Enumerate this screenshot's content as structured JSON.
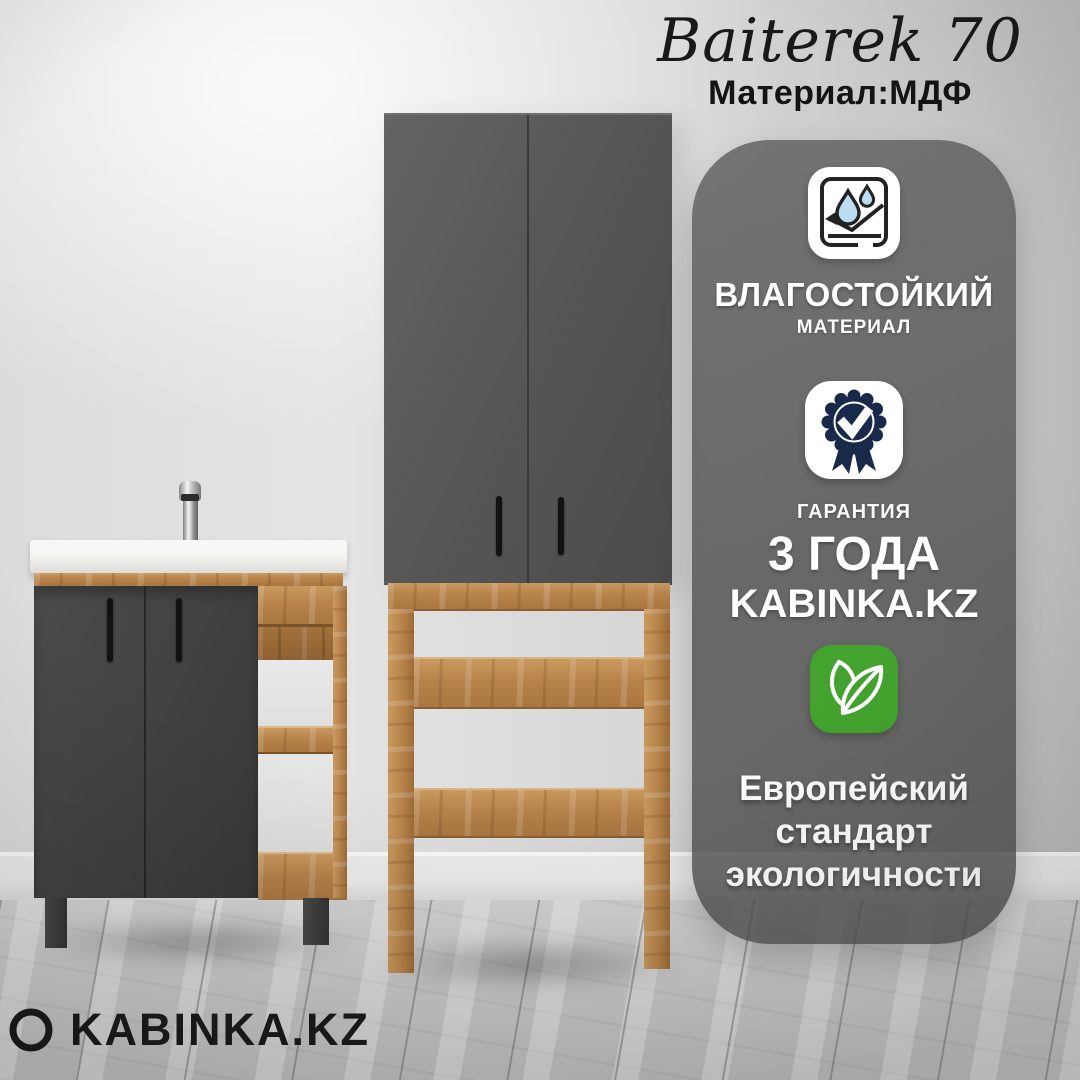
{
  "header": {
    "title": "Baiterek 70",
    "material": "Материал:МДФ"
  },
  "panel": {
    "waterproof": {
      "icon": "water-resistant-icon",
      "title": "ВЛАГОСТОЙКИЙ",
      "subtitle": "МАТЕРИАЛ"
    },
    "warranty": {
      "icon": "warranty-badge-icon",
      "label": "ГАРАНТИЯ",
      "years": "3 ГОДА",
      "brand": "KABINKA.KZ"
    },
    "eco": {
      "icon": "eco-leaves-icon",
      "lines": [
        "Европейский",
        "стандарт",
        "экологичности"
      ]
    }
  },
  "footer": {
    "brand": "KABINKA.KZ"
  },
  "colors": {
    "eco_green": "#43a32e",
    "badge_navy": "#19294a",
    "droplet_blue": "#bcdcf2",
    "panel_overlay": "#565656",
    "wood": "#b7834b",
    "door_gray": "#4f4f4f"
  }
}
